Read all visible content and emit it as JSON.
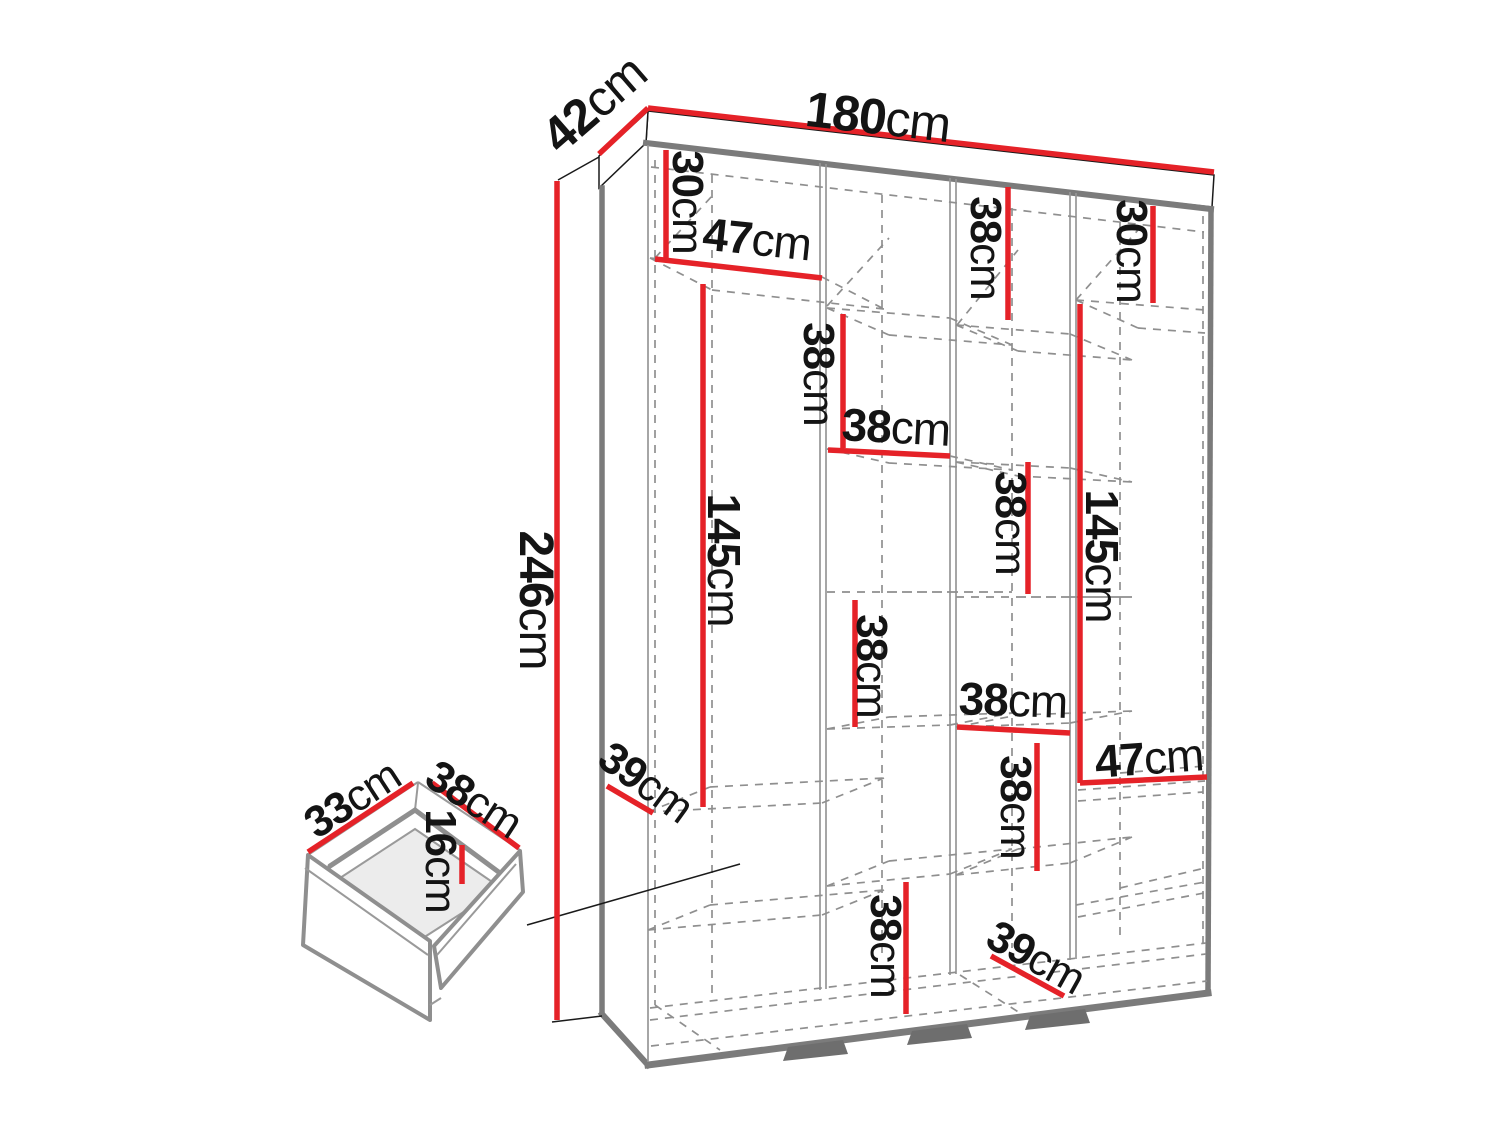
{
  "meta": {
    "description": "Wardrobe interior dimension diagram with detail drawing of a drawer",
    "units": "cm"
  },
  "colors": {
    "dimension_red": "#e52228",
    "outline_gray": "#7b7b7b",
    "dash_gray": "#8f8f8f",
    "text_black": "#141414",
    "interior_fill": "#ececec",
    "foot_gray": "#6e6e6e",
    "background": "#ffffff"
  },
  "overall_dimensions": {
    "width": "180cm",
    "depth": "42cm",
    "height": "246cm"
  },
  "drawer_dimensions": {
    "side": "33cm",
    "front": "38cm",
    "height": "16cm"
  },
  "diagram": {
    "labels": [
      {
        "id": "height-246",
        "value": "246",
        "unit": "cm",
        "x": 536,
        "y": 600,
        "rot": 90,
        "size": 48
      },
      {
        "id": "width-180",
        "value": "180",
        "unit": "cm",
        "x": 878,
        "y": 117,
        "rot": 6.5,
        "size": 50
      },
      {
        "id": "depth-42",
        "value": "42",
        "unit": "cm",
        "x": 594,
        "y": 104,
        "rot": -41,
        "size": 50
      },
      {
        "id": "c1-30",
        "value": "30",
        "unit": "cm",
        "x": 688,
        "y": 202,
        "rot": 90,
        "size": 44
      },
      {
        "id": "c1-47",
        "value": "47",
        "unit": "cm",
        "x": 757,
        "y": 239,
        "rot": 6,
        "size": 46
      },
      {
        "id": "c1-145",
        "value": "145",
        "unit": "cm",
        "x": 724,
        "y": 560,
        "rot": 90,
        "size": 46
      },
      {
        "id": "c1-39",
        "value": "39",
        "unit": "cm",
        "x": 646,
        "y": 782,
        "rot": 36,
        "size": 44
      },
      {
        "id": "c2-38-upper",
        "value": "38",
        "unit": "cm",
        "x": 819,
        "y": 374,
        "rot": 90,
        "size": 44
      },
      {
        "id": "c2-38-shelf",
        "value": "38",
        "unit": "cm",
        "x": 896,
        "y": 427,
        "rot": 3,
        "size": 46
      },
      {
        "id": "c2-38-middle",
        "value": "38",
        "unit": "cm",
        "x": 872,
        "y": 666,
        "rot": 90,
        "size": 44
      },
      {
        "id": "c2-38-lower",
        "value": "38",
        "unit": "cm",
        "x": 886,
        "y": 946,
        "rot": 90,
        "size": 44
      },
      {
        "id": "c3-38-upper",
        "value": "38",
        "unit": "cm",
        "x": 986,
        "y": 248,
        "rot": 90,
        "size": 44
      },
      {
        "id": "c3-38-middle",
        "value": "38",
        "unit": "cm",
        "x": 1011,
        "y": 523,
        "rot": 90,
        "size": 44
      },
      {
        "id": "c3-38-shelf",
        "value": "38",
        "unit": "cm",
        "x": 1013,
        "y": 700,
        "rot": 2,
        "size": 46
      },
      {
        "id": "c3-38-lower",
        "value": "38",
        "unit": "cm",
        "x": 1016,
        "y": 807,
        "rot": 90,
        "size": 44
      },
      {
        "id": "c3-39",
        "value": "39",
        "unit": "cm",
        "x": 1036,
        "y": 957,
        "rot": 29,
        "size": 44
      },
      {
        "id": "c4-30",
        "value": "30",
        "unit": "cm",
        "x": 1132,
        "y": 251,
        "rot": 90,
        "size": 44
      },
      {
        "id": "c4-145",
        "value": "145",
        "unit": "cm",
        "x": 1102,
        "y": 556,
        "rot": 90,
        "size": 46
      },
      {
        "id": "c4-47",
        "value": "47",
        "unit": "cm",
        "x": 1149,
        "y": 758,
        "rot": -4,
        "size": 46
      },
      {
        "id": "drawer-33",
        "value": "33",
        "unit": "cm",
        "x": 352,
        "y": 799,
        "rot": -33,
        "size": 44
      },
      {
        "id": "drawer-38",
        "value": "38",
        "unit": "cm",
        "x": 474,
        "y": 799,
        "rot": 33,
        "size": 44
      },
      {
        "id": "drawer-16",
        "value": "16",
        "unit": "cm",
        "x": 441,
        "y": 861,
        "rot": 90,
        "size": 44
      }
    ],
    "dimension_lines": [
      {
        "id": "height-246",
        "x1": 557,
        "y1": 181,
        "x2": 557,
        "y2": 1020
      },
      {
        "id": "width-180",
        "x1": 648,
        "y1": 108,
        "x2": 1214,
        "y2": 172
      },
      {
        "id": "depth-42",
        "x1": 648,
        "y1": 108,
        "x2": 599,
        "y2": 154
      },
      {
        "id": "c1-30",
        "x1": 666,
        "y1": 150,
        "x2": 666,
        "y2": 258
      },
      {
        "id": "c1-47",
        "x1": 655,
        "y1": 259,
        "x2": 822,
        "y2": 278
      },
      {
        "id": "c1-145",
        "x1": 703,
        "y1": 284,
        "x2": 703,
        "y2": 807
      },
      {
        "id": "c1-39",
        "x1": 607,
        "y1": 786,
        "x2": 653,
        "y2": 813
      },
      {
        "id": "c2-38-upper",
        "x1": 843,
        "y1": 314,
        "x2": 843,
        "y2": 448
      },
      {
        "id": "c2-38-shelf",
        "x1": 828,
        "y1": 450,
        "x2": 950,
        "y2": 456
      },
      {
        "id": "c2-38-middle",
        "x1": 855,
        "y1": 600,
        "x2": 855,
        "y2": 727
      },
      {
        "id": "c2-38-lower",
        "x1": 906,
        "y1": 882,
        "x2": 906,
        "y2": 1014
      },
      {
        "id": "c3-38-upper",
        "x1": 1008,
        "y1": 187,
        "x2": 1008,
        "y2": 320
      },
      {
        "id": "c3-38-middle",
        "x1": 1028,
        "y1": 462,
        "x2": 1028,
        "y2": 594
      },
      {
        "id": "c3-38-shelf",
        "x1": 957,
        "y1": 727,
        "x2": 1070,
        "y2": 733
      },
      {
        "id": "c3-38-lower",
        "x1": 1037,
        "y1": 743,
        "x2": 1037,
        "y2": 871
      },
      {
        "id": "c3-39",
        "x1": 991,
        "y1": 956,
        "x2": 1064,
        "y2": 996
      },
      {
        "id": "c4-30",
        "x1": 1153,
        "y1": 206,
        "x2": 1153,
        "y2": 303
      },
      {
        "id": "c4-145",
        "x1": 1080,
        "y1": 304,
        "x2": 1080,
        "y2": 783
      },
      {
        "id": "c4-47",
        "x1": 1080,
        "y1": 783,
        "x2": 1207,
        "y2": 777
      },
      {
        "id": "drawer-33",
        "x1": 308,
        "y1": 852,
        "x2": 413,
        "y2": 783
      },
      {
        "id": "drawer-38",
        "x1": 432,
        "y1": 783,
        "x2": 519,
        "y2": 848
      },
      {
        "id": "drawer-16",
        "x1": 462,
        "y1": 845,
        "x2": 462,
        "y2": 884
      }
    ]
  }
}
